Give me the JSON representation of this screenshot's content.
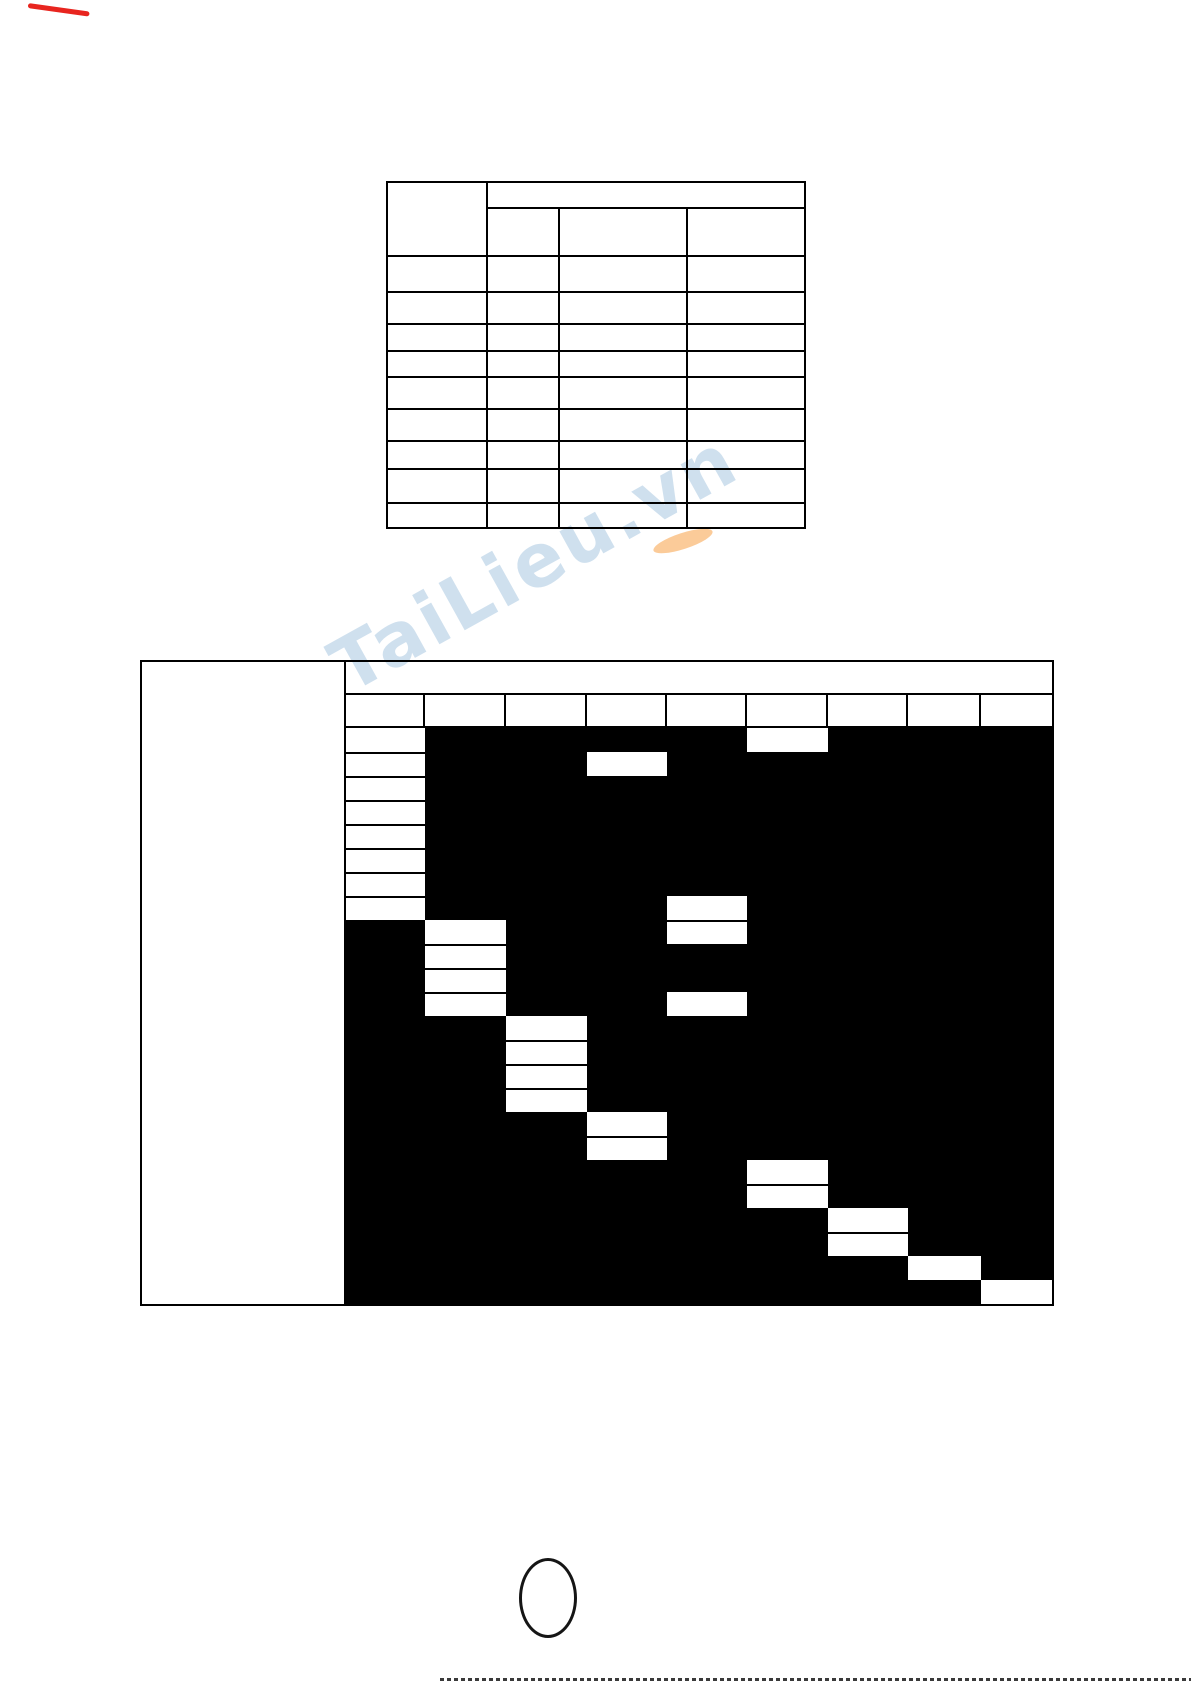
{
  "page": {
    "background": "#ffffff",
    "ink_color": "#000000",
    "red_mark_color": "#e8251f"
  },
  "watermark": {
    "text": "TaiLieu.vn",
    "color": "#a8c6e0",
    "swoosh_color": "#f7a046"
  },
  "top_table": {
    "note": "blank template table - no visible text in any cell",
    "columns": 4,
    "header_rows": 2,
    "body_rows": 9,
    "cell_text": ""
  },
  "gantt_table": {
    "note": "blank gantt/schedule matrix - black body with white bar cells, no visible text",
    "label_column_text": "",
    "header_row1_text": "",
    "time_columns": 9,
    "body_rows": 24,
    "row_height": 24,
    "bars": [
      {
        "col": 1,
        "row": 1,
        "span": 8
      },
      {
        "col": 2,
        "row": 9,
        "span": 4
      },
      {
        "col": 3,
        "row": 13,
        "span": 4
      },
      {
        "col": 4,
        "row": 2,
        "span": 1
      },
      {
        "col": 4,
        "row": 17,
        "span": 2
      },
      {
        "col": 5,
        "row": 8,
        "span": 2
      },
      {
        "col": 5,
        "row": 12,
        "span": 1
      },
      {
        "col": 6,
        "row": 1,
        "span": 1
      },
      {
        "col": 6,
        "row": 19,
        "span": 2
      },
      {
        "col": 7,
        "row": 21,
        "span": 2
      },
      {
        "col": 8,
        "row": 23,
        "span": 1
      },
      {
        "col": 9,
        "row": 24,
        "span": 1
      }
    ]
  }
}
